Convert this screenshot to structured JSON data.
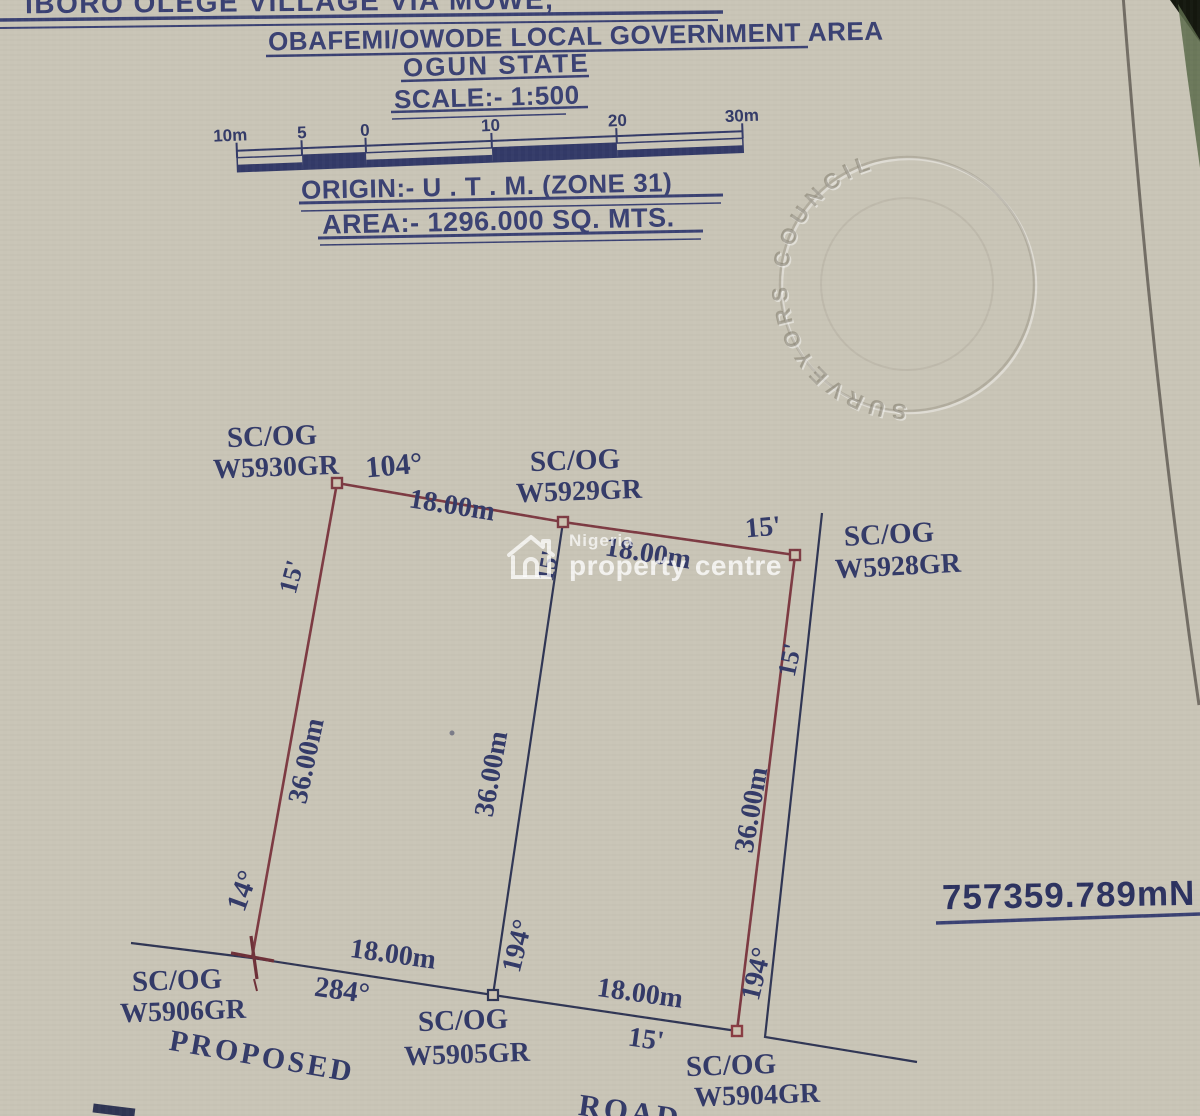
{
  "document": {
    "title_line1": "IBORO OLEGE VILLAGE VIA MOWE,",
    "title_line2": "OBAFEMI/OWODE LOCAL GOVERNMENT AREA",
    "title_line3": "OGUN STATE",
    "scale_line": "SCALE:- 1:500",
    "origin_line": "ORIGIN:- U . T . M. (ZONE 31)",
    "area_line": "AREA:- 1296.000 SQ. MTS."
  },
  "scale_bar": {
    "tick_labels": [
      "10m",
      "5",
      "0",
      "10",
      "20",
      "30m"
    ]
  },
  "seal": {
    "text": "SURVEYORS  COUNCIL"
  },
  "watermark": {
    "brand_top": "Nigeria",
    "brand_bottom": "property centre"
  },
  "coordinate_label": "757359.789mN",
  "colors": {
    "paper": "#c9c5b7",
    "ink": "#333a68",
    "boundary_red": "#7d3a42",
    "line_dark": "#2f3554"
  },
  "plot": {
    "beacons": [
      "SC/OG W5930GR",
      "SC/OG W5929GR",
      "SC/OG W5928GR",
      "SC/OG W5906GR",
      "SC/OG W5905GR",
      "SC/OG W5904GR"
    ],
    "labels": [
      {
        "name": "beacon-label-scog-w5930",
        "text": "SC/OG",
        "x": 272,
        "y": 437,
        "rot": -2,
        "size": 29
      },
      {
        "name": "beacon-label-w5930gr",
        "text": "W5930GR",
        "x": 276,
        "y": 468,
        "rot": -2,
        "size": 28
      },
      {
        "name": "angle-104",
        "text": "104°",
        "x": 394,
        "y": 466,
        "rot": -5,
        "size": 30
      },
      {
        "name": "dim-top-left-18m",
        "text": "18.00m",
        "x": 452,
        "y": 506,
        "rot": 9,
        "size": 28
      },
      {
        "name": "beacon-label-scog-w5929",
        "text": "SC/OG",
        "x": 575,
        "y": 461,
        "rot": -2,
        "size": 29
      },
      {
        "name": "beacon-label-w5929gr",
        "text": "W5929GR",
        "x": 579,
        "y": 492,
        "rot": -2,
        "size": 28
      },
      {
        "name": "dim-top-right-18m",
        "text": "18.00m",
        "x": 648,
        "y": 554,
        "rot": 9,
        "size": 28
      },
      {
        "name": "bearing-15min-top",
        "text": "15'",
        "x": 763,
        "y": 528,
        "rot": -5,
        "size": 28
      },
      {
        "name": "beacon-label-scog-w5928",
        "text": "SC/OG",
        "x": 889,
        "y": 535,
        "rot": -3,
        "size": 29
      },
      {
        "name": "beacon-label-w5928gr",
        "text": "W5928GR",
        "x": 898,
        "y": 567,
        "rot": -3,
        "size": 28
      },
      {
        "name": "bearing-15min-mid",
        "text": "15'",
        "x": 549,
        "y": 566,
        "rot": -80,
        "size": 24
      },
      {
        "name": "bearing-15min-left",
        "text": "15'",
        "x": 292,
        "y": 577,
        "rot": -75,
        "size": 26
      },
      {
        "name": "dim-left-36m",
        "text": "36.00m",
        "x": 307,
        "y": 761,
        "rot": -78,
        "size": 28
      },
      {
        "name": "angle-14",
        "text": "14°",
        "x": 243,
        "y": 891,
        "rot": -70,
        "size": 29
      },
      {
        "name": "dim-mid-36m",
        "text": "36.00m",
        "x": 492,
        "y": 774,
        "rot": -80,
        "size": 28
      },
      {
        "name": "angle-194-mid",
        "text": "194°",
        "x": 518,
        "y": 946,
        "rot": -76,
        "size": 28
      },
      {
        "name": "bearing-15min-right",
        "text": "15'",
        "x": 790,
        "y": 660,
        "rot": -78,
        "size": 26
      },
      {
        "name": "dim-right-36m",
        "text": "36.00m",
        "x": 752,
        "y": 810,
        "rot": -80,
        "size": 28
      },
      {
        "name": "angle-194-right",
        "text": "194°",
        "x": 757,
        "y": 974,
        "rot": -76,
        "size": 28
      },
      {
        "name": "dim-bottom-left-18m",
        "text": "18.00m",
        "x": 393,
        "y": 955,
        "rot": 8,
        "size": 28
      },
      {
        "name": "angle-284",
        "text": "284°",
        "x": 342,
        "y": 991,
        "rot": 8,
        "size": 29
      },
      {
        "name": "beacon-label-scog-w5906",
        "text": "SC/OG",
        "x": 177,
        "y": 981,
        "rot": -2,
        "size": 29
      },
      {
        "name": "beacon-label-w5906gr",
        "text": "W5906GR",
        "x": 183,
        "y": 1012,
        "rot": -2,
        "size": 28
      },
      {
        "name": "proposed-label",
        "text": "PROPOSED",
        "x": 262,
        "y": 1057,
        "rot": 10,
        "size": 30,
        "ls": 3
      },
      {
        "name": "beacon-label-scog-w5905",
        "text": "SC/OG",
        "x": 463,
        "y": 1021,
        "rot": -2,
        "size": 29
      },
      {
        "name": "beacon-label-w5905gr",
        "text": "W5905GR",
        "x": 467,
        "y": 1055,
        "rot": -2,
        "size": 28
      },
      {
        "name": "dim-bottom-right-18m",
        "text": "18.00m",
        "x": 640,
        "y": 994,
        "rot": 8,
        "size": 28
      },
      {
        "name": "bearing-15min-bottom",
        "text": "15'",
        "x": 646,
        "y": 1040,
        "rot": 8,
        "size": 28
      },
      {
        "name": "beacon-label-scog-w5904",
        "text": "SC/OG",
        "x": 731,
        "y": 1066,
        "rot": -2,
        "size": 29
      },
      {
        "name": "beacon-label-w5904gr",
        "text": "W5904GR",
        "x": 757,
        "y": 1096,
        "rot": -2,
        "size": 28
      },
      {
        "name": "road-label",
        "text": "ROAD",
        "x": 630,
        "y": 1112,
        "rot": 8,
        "size": 31,
        "ls": 3
      }
    ]
  }
}
